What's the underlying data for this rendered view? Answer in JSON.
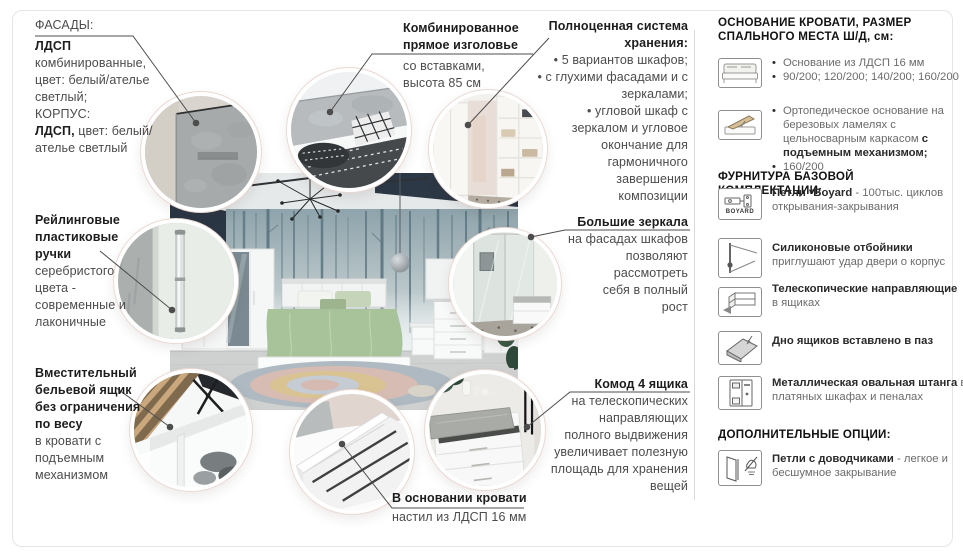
{
  "colors": {
    "text": "#4c4c4c",
    "heading": "#1d1d1d",
    "connector": "#4d4d4d",
    "divider": "#d9d9d9",
    "card_border": "#e7e4e1"
  },
  "callouts": {
    "facades": {
      "l1": "ФАСАДЫ:",
      "l2": "ЛДСП",
      "l3": "комбинированные,",
      "l4": "цвет: белый/ателье",
      "l5": "светлый;",
      "l6": "КОРПУС:",
      "l7b": "ЛДСП,",
      "l7r": " цвет: белый/",
      "l8": "ателье светлый"
    },
    "handles": {
      "h1": "Рейлинговые",
      "h2": "пластиковые",
      "h3": "ручки",
      "b1": "серебристого",
      "b2": "цвета -",
      "b3": "современные и",
      "b4": "лаконичные"
    },
    "linen": {
      "h1": "Вместительный",
      "h2": "бельевой ящик",
      "h3": "без ограничения",
      "h4": "по весу",
      "b1": "в кровати с",
      "b2": "подъемным",
      "b3": "механизмом"
    },
    "headboard": {
      "h1": "Комбинированное",
      "h2": "прямое изголовье",
      "b1": "со вставками,",
      "b2": "высота 85 см"
    },
    "storage": {
      "h1": "Полноценная система",
      "h2": "хранения:",
      "l1": "• 5 вариантов шкафов;",
      "l2": "• с глухими фасадами и с",
      "l3": "зеркалами;",
      "l4": "• угловой шкаф с",
      "l5": "зеркалом и угловое",
      "l6": "окончание для",
      "l7": "гармоничного",
      "l8": "завершения",
      "l9": "композиции"
    },
    "mirrors": {
      "h": "Большие зеркала",
      "l1": "на фасадах шкафов",
      "l2": "позволяют",
      "l3": "рассмотреть",
      "l4": "себя в полный",
      "l5": "рост"
    },
    "chest": {
      "h": "Комод 4 ящика",
      "l1": "на телескопических",
      "l2": "направляющих",
      "l3": "полного выдвижения",
      "l4": "увеличивает полезную",
      "l5": "площадь для хранения",
      "l6": "вещей"
    },
    "bedbase": {
      "h": "В основании кровати",
      "b": "настил из ЛДСП 16 мм"
    }
  },
  "sidebar": {
    "s1_heading": "ОСНОВАНИЕ КРОВАТИ, РАЗМЕР СПАЛЬНОГО МЕСТА Ш/Д, см:",
    "base_item1": {
      "icon": "bed-icon",
      "bullet1": "Основание из ЛДСП 16 мм",
      "bullet2": "90/200; 120/200; 140/200; 160/200"
    },
    "base_item2": {
      "icon": "lift-bed-icon",
      "bullet1_pre": "Ортопедическое основание на березовых ламелях с цельносварным каркасом ",
      "bullet1_bold": "с подъемным механизмом;",
      "bullet2": "160/200"
    },
    "s2_heading": "ФУРНИТУРА БАЗОВОЙ КОМПЛЕКТАЦИИ:",
    "hinges": {
      "label": "BOYARD",
      "bold": "Петли *Boyard",
      "rest": " - 100тыс. циклов",
      "line2": "открывания-закрывания"
    },
    "bumpers": {
      "bold": "Силиконовые отбойники",
      "line2": "приглушают удар двери о корпус"
    },
    "telescopic": {
      "bold": "Телескопические направляющие",
      "line2": "в ящиках"
    },
    "groove": {
      "bold": "Дно ящиков вставлено в паз"
    },
    "rod": {
      "bold": "Металлическая овальная штанга",
      "rest": " в",
      "line2": "платяных шкафах и пеналах"
    },
    "s3_heading": "ДОПОЛНИТЕЛЬНЫЕ ОПЦИИ:",
    "closers": {
      "bold": "Петли с доводчиками",
      "rest": " - легкое и",
      "line2": "бесшумное закрывание"
    }
  }
}
